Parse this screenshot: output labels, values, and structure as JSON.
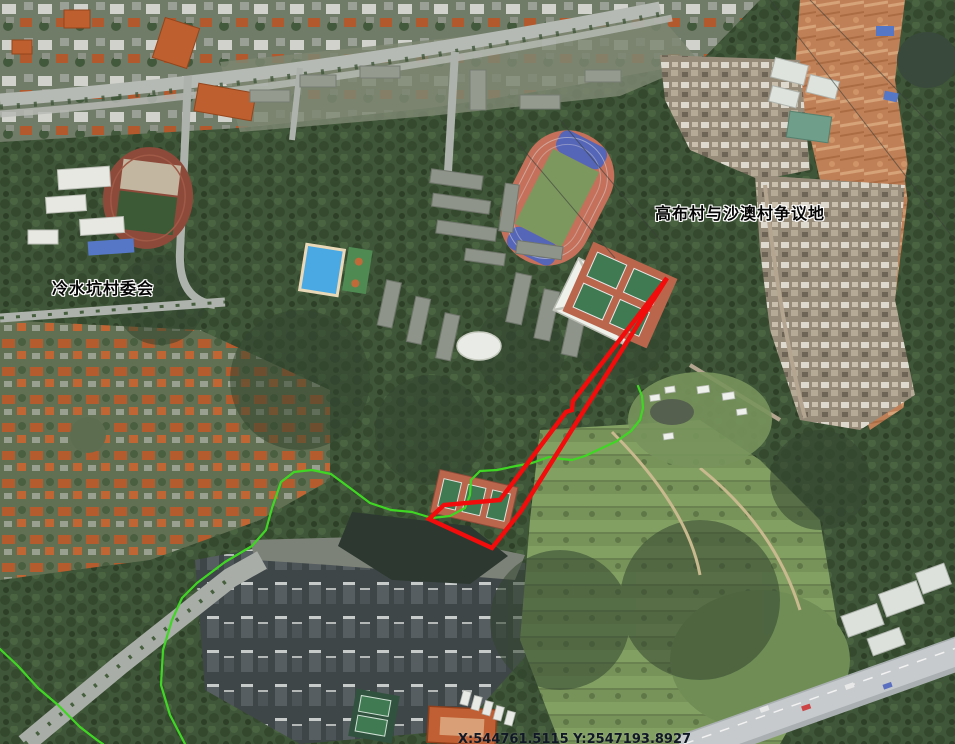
{
  "map": {
    "labels": {
      "village_committee": "冷水坑村委会",
      "disputed_area": "高布村与沙澳村争议地"
    },
    "status_bar": {
      "coordinates": "X:544761.5115 Y:2547193.8927"
    },
    "overlay": {
      "dispute_polygon": {
        "color": "#F20C0C",
        "points": "667,278 521,511 492,548 429,519 444,505 500,500 566,412 572,410 573,401"
      },
      "boundary_line_main": {
        "color": "#3FD723",
        "points": "185,744 170,715 161,685 163,650 172,620 182,598 197,583 225,562 252,546 266,530 272,508 281,482 294,472 312,470 331,474 350,488 370,503 391,510 412,512 432,518 450,516 465,508 470,495 471,480 480,471 497,470 516,466 532,463 549,457 562,459 572,460 585,456 600,449 617,441 631,431 640,420 643,408 642,396 638,386"
      },
      "boundary_line_west": {
        "color": "#3FD723",
        "points": "0,649 18,666 38,688 58,705 80,727 97,740 103,744"
      }
    }
  }
}
